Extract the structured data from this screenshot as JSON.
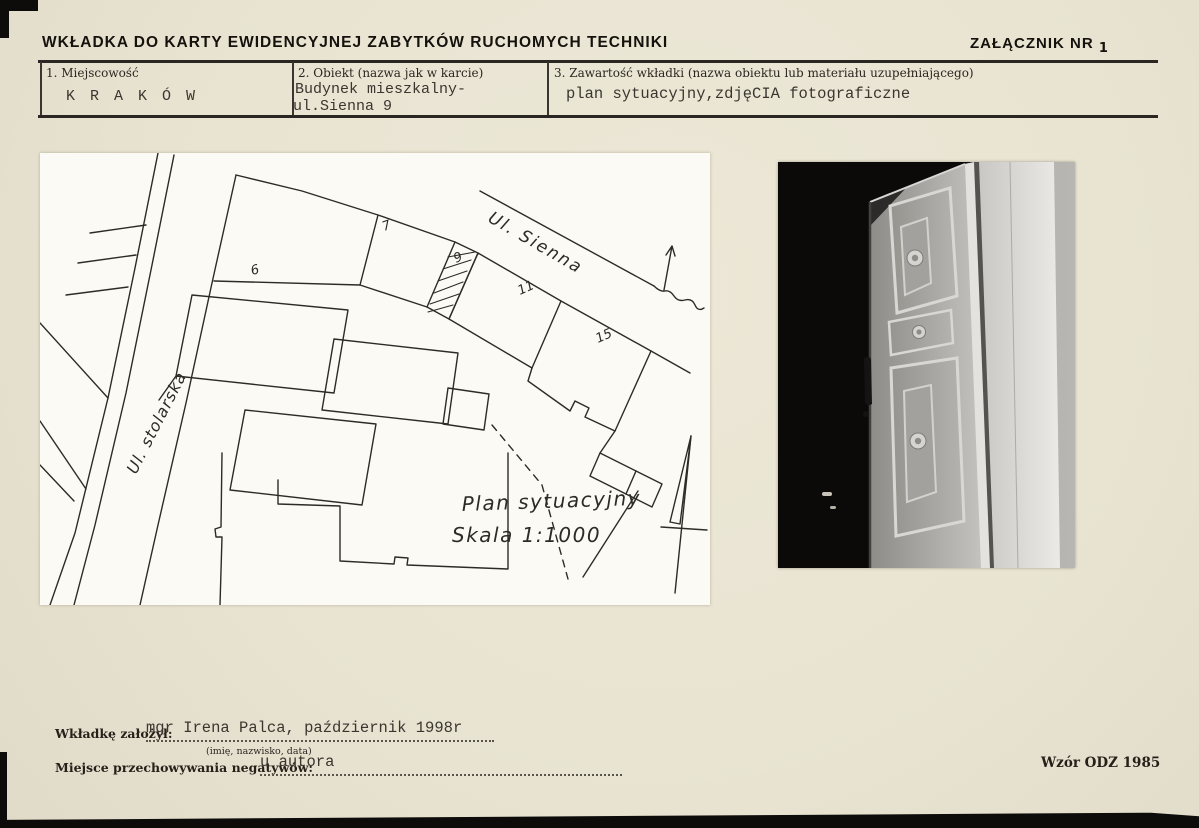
{
  "header": {
    "title": "WKŁADKA DO KARTY EWIDENCYJNEJ ZABYTKÓW RUCHOMYCH TECHNIKI",
    "attachment_label": "ZAŁĄCZNIK NR",
    "attachment_number": "1"
  },
  "fields": {
    "field1": {
      "label": "1. Miejscowość",
      "value": "K R A K Ó W"
    },
    "field2": {
      "label": "2. Obiekt (nazwa jak w karcie)",
      "line1": "Budynek mieszkalny-",
      "line2": "ul.Sienna 9"
    },
    "field3": {
      "label": "3. Zawartość wkładki (nazwa obiektu lub materiału uzupełniającego)",
      "value": "plan sytuacyjny,zdjęCIA fotograficzne"
    }
  },
  "plan": {
    "street_sienna": "Ul. Sienna",
    "street_stolarska": "Ul. stolarska",
    "numbers": {
      "n6": "6",
      "n7": "7",
      "n9": "9",
      "n11": "11",
      "n15": "15"
    },
    "caption_title": "Plan sytuacyjny",
    "caption_scale": "Skala 1:1000"
  },
  "photo": {
    "description": "black-and-white photograph of a panelled door with rosettes"
  },
  "footer": {
    "founder_label": "Wkładkę założył:",
    "founder_value": "mgr Irena Palca, październik 1998r",
    "founder_hint": "(imię, nazwisko, data)",
    "negatives_label": "Miejsce przechowywania negatywów:",
    "negatives_value": "u autora",
    "form_code": "Wzór ODZ 1985"
  },
  "colors": {
    "paper": "#e9e4d2",
    "ink": "#25211a",
    "sheet": "#fbfaf4",
    "rule": "#2a2722"
  }
}
